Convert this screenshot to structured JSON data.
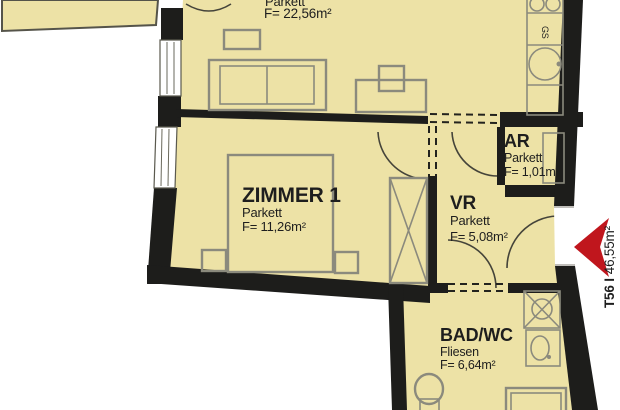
{
  "colors": {
    "background": "#FFFFFF",
    "floor_fill": "#EDE2A6",
    "wall": "#1D1D1B",
    "furniture_stroke": "#8B8A7D",
    "entrance_arrow_red": "#C0161D",
    "text": "#1E1E1E"
  },
  "rooms": {
    "living": {
      "floor": "Parkett",
      "area": "F= 22,56m²"
    },
    "zimmer1": {
      "name": "ZIMMER 1",
      "floor": "Parkett",
      "area": "F= 11,26m²"
    },
    "ar": {
      "name": "AR",
      "floor": "Parkett",
      "area": "F= 1,01m²"
    },
    "vr": {
      "name": "VR",
      "floor": "Parkett",
      "area": "F= 5,08m²"
    },
    "bad": {
      "name": "BAD/WC",
      "floor": "Fliesen",
      "area": "F= 6,64m²"
    }
  },
  "kitchen": {
    "dishwasher": "GS"
  },
  "entrance": {
    "unit": "T56 I",
    "area": "46,55m²"
  }
}
